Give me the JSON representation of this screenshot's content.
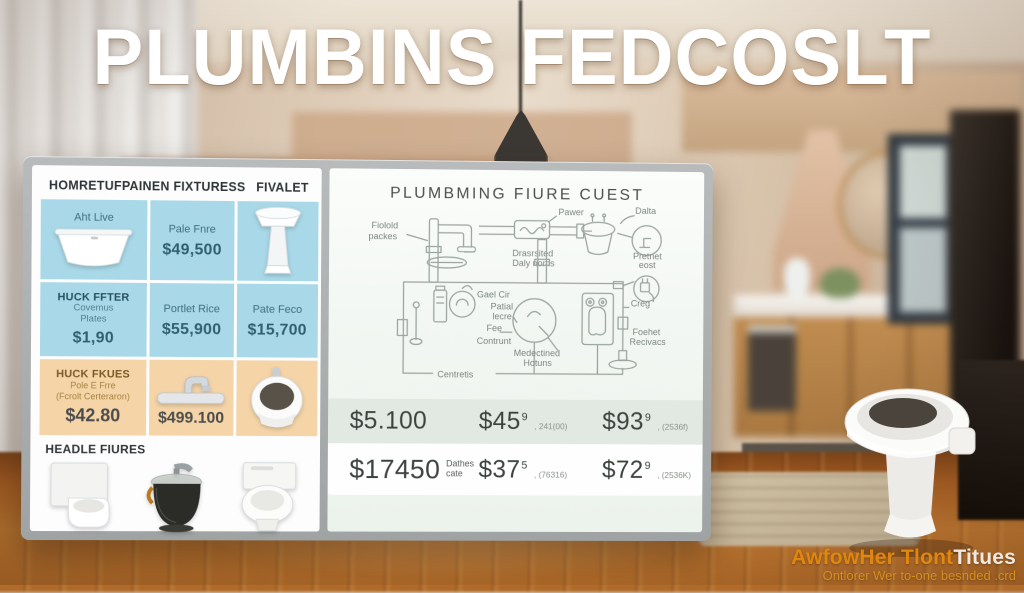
{
  "title": "PLUMBINS FEDCOSLT",
  "board": {
    "header_left": "HOMRETUFPAINEN FIXTURESS",
    "header_right": "FIVALET",
    "r1": {
      "c1_label": "Aht Live",
      "c2_name": "Pale Fnre",
      "c2_price": "$49,500"
    },
    "r2": {
      "c1_title": "HUCK FFTER",
      "c1_note1": "Covemus",
      "c1_note2": "Plates",
      "c1_price": "$1,90",
      "c2_name": "Portlet Rice",
      "c2_price": "$55,900",
      "c3_name": "Pate Feco",
      "c3_price": "$15,700"
    },
    "r3": {
      "c1_title": "HUCK FKUES",
      "c1_note1": "Pole E Frre",
      "c1_note2": "(Fcrolt Certeraron)",
      "c1_price": "$42.80",
      "c2_price": "$499.100"
    },
    "r4": {
      "title": "HEADLE FIURES"
    }
  },
  "whiteboard": {
    "title": "PLUMBMING FIURE CUEST",
    "labels": {
      "pipe1a": "Fiolold",
      "pipe1b": "packes",
      "pawer": "Pawer",
      "dalta": "Dalta",
      "drain1": "Drasrsited",
      "drain2": "Daly noms",
      "pretnet1": "Pretnet",
      "pretnet2": "eost",
      "gael": "Gael Cir",
      "patial1": "Patial",
      "patial2": "lecre",
      "fee": "Fee",
      "contrunt": "Contrunt",
      "creg": "Creg",
      "med1": "Medectined",
      "med2": "Hotuns",
      "foehet1": "Foehet",
      "foehet2": "Recivacs",
      "centretis": "Centretis"
    },
    "prices": {
      "r1c1": {
        "v": "$5.100"
      },
      "r1c2": {
        "v": "$45",
        "sup": "9",
        "note": ", 241(00)"
      },
      "r1c3": {
        "v": "$93",
        "sup": "9",
        "note": ", (2536f)"
      },
      "r2c1": {
        "v": "$17450",
        "note1": "Dathes",
        "note2": "cate"
      },
      "r2c2": {
        "v": "$37",
        "sup": "5",
        "note": ", (76316)"
      },
      "r2c3": {
        "v": "$72",
        "sup": "9",
        "note": ", (2536K)"
      }
    }
  },
  "watermark": {
    "brand_orange": "AwfowHer Tlont",
    "brand_light": "Titues",
    "tagline": "Ontlorer Wer to-one besnded .crd"
  },
  "colors": {
    "row_blue": "#a9d9e8",
    "row_peach": "#f5d5a8",
    "bezel_gray": "#a9adae",
    "accent_orange": "#e0870f",
    "wood_floor": "#b06a28"
  }
}
